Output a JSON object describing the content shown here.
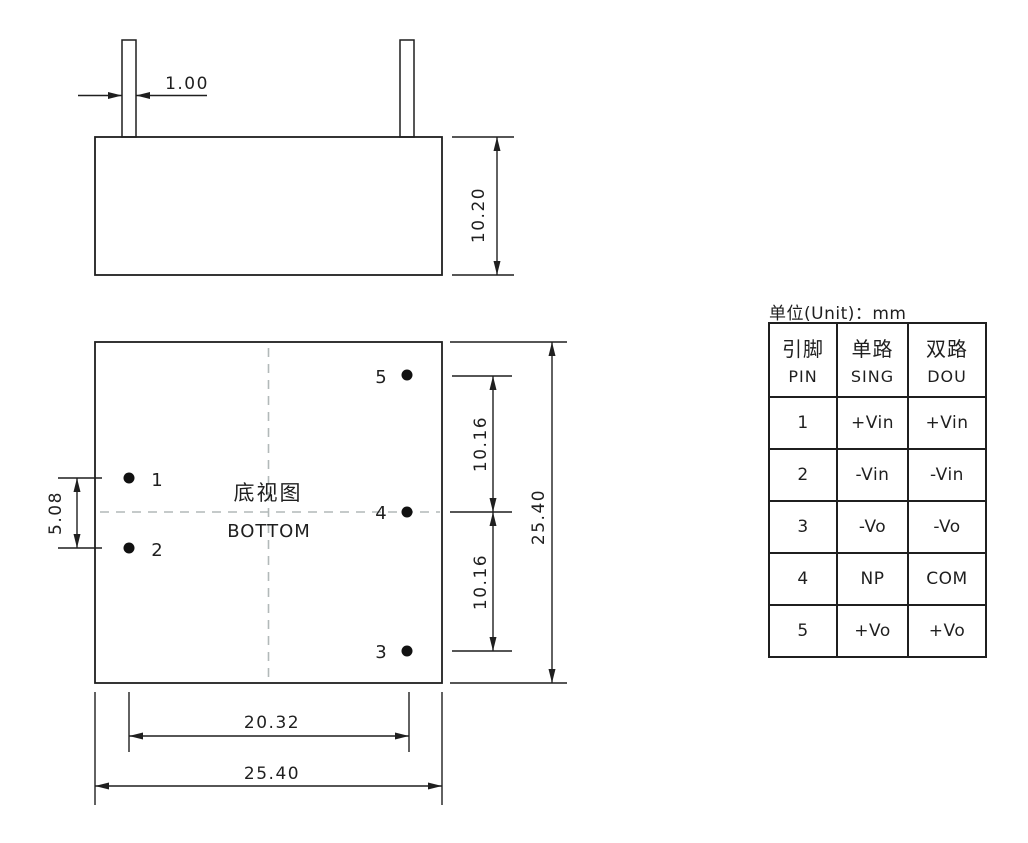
{
  "side_view": {
    "dim_pin_width": "1.00",
    "dim_body_height": "10.20"
  },
  "bottom_view": {
    "title_cn": "底视图",
    "title_en": "BOTTOM",
    "pin_labels": {
      "p1": "1",
      "p2": "2",
      "p3": "3",
      "p4": "4",
      "p5": "5"
    },
    "dim_pin_pitch_left": "5.08",
    "dim_pitch_upper": "10.16",
    "dim_pitch_lower": "10.16",
    "dim_body_height": "25.40",
    "dim_pin_span": "20.32",
    "dim_body_width": "25.40"
  },
  "pin_table": {
    "unit_label": "单位(Unit)：mm",
    "columns": [
      {
        "cn": "引脚",
        "en": "PIN"
      },
      {
        "cn": "单路",
        "en": "SING"
      },
      {
        "cn": "双路",
        "en": "DOU"
      }
    ],
    "rows": [
      {
        "pin": "1",
        "sing": "+Vin",
        "dou": "+Vin"
      },
      {
        "pin": "2",
        "sing": "-Vin",
        "dou": "-Vin"
      },
      {
        "pin": "3",
        "sing": "-Vo",
        "dou": "-Vo"
      },
      {
        "pin": "4",
        "sing": "NP",
        "dou": "COM"
      },
      {
        "pin": "5",
        "sing": "+Vo",
        "dou": "+Vo"
      }
    ]
  },
  "colors": {
    "line": "#1f1f1f",
    "centerline": "#b2b9b9",
    "background": "#ffffff"
  }
}
